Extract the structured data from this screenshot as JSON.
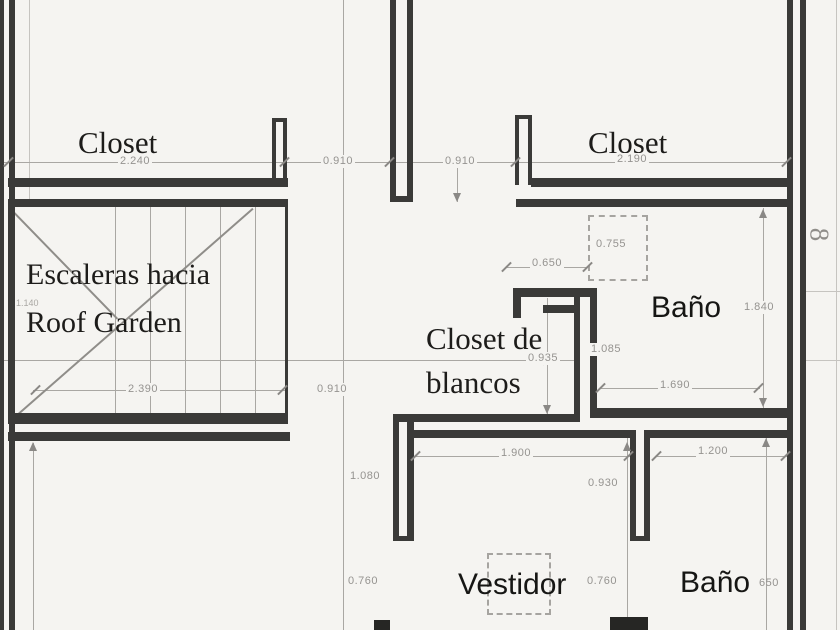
{
  "plan": {
    "title": "floor-plan",
    "rooms": {
      "closet_left": "Closet",
      "closet_right": "Closet",
      "stairs_line1": "Escaleras hacia",
      "stairs_line2": "Roof Garden",
      "closet_blancos_line1": "Closet de",
      "closet_blancos_line2": "blancos",
      "bano_upper": "Baño",
      "vestidor": "Vestidor",
      "bano_lower": "Baño"
    },
    "dims": {
      "d2240": "2.240",
      "d0910_top_left": "0.910",
      "d0910_top_right": "0.910",
      "d2190": "2.190",
      "d1140": "1.140",
      "d2390": "2.390",
      "d0910_mid": "0.910",
      "d0935": "0.935",
      "d1085": "1.085",
      "d0755": "0.755",
      "d0650": "0.650",
      "d1840": "1.840",
      "d1690": "1.690",
      "d1080": "1.080",
      "d1900": "1.900",
      "d1200": "1.200",
      "d0930": "0.930",
      "d0760_left": "0.760",
      "d0760_mid": "0.760",
      "d650_right": "650",
      "edge_8": "8"
    },
    "colors": {
      "wall": "#3a3a38",
      "thin_line": "#a9a7a3",
      "dim_text": "#959390",
      "background": "#f5f4f1"
    }
  }
}
